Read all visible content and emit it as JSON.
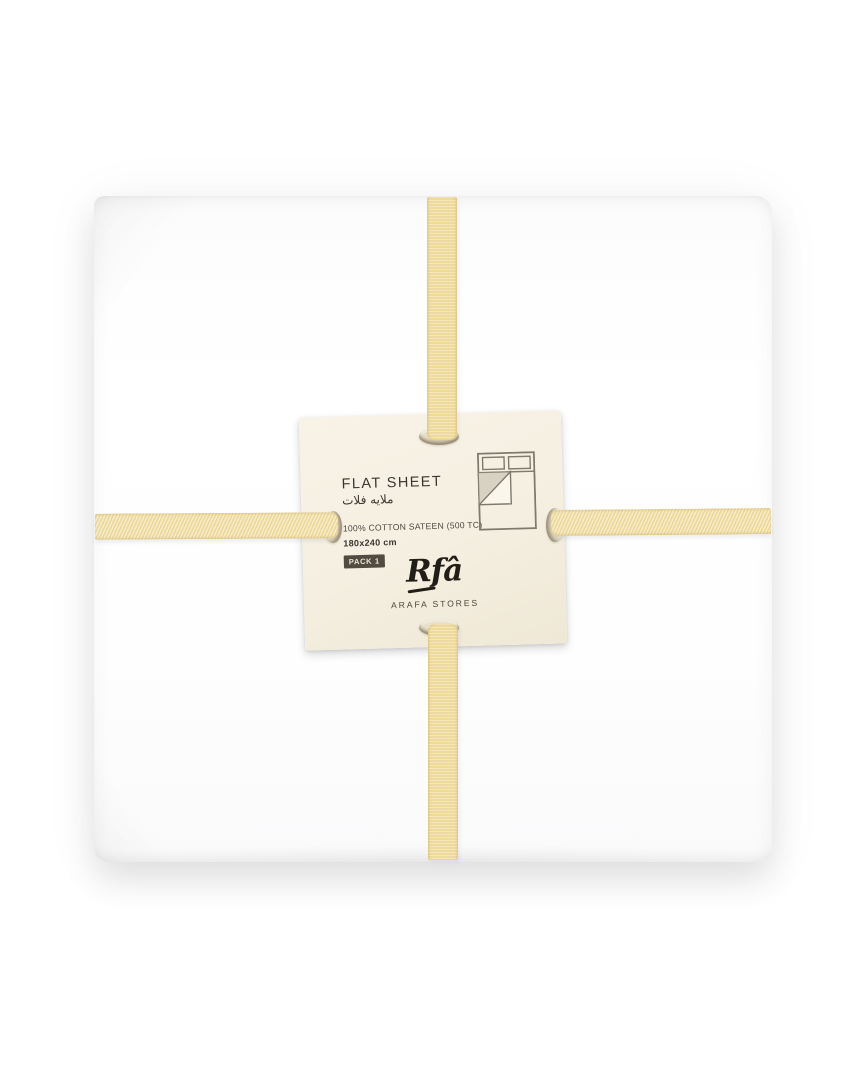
{
  "product": {
    "label": {
      "title": "FLAT SHEET",
      "title_arabic": "ملايه فلات",
      "material": "100% COTTON SATEEN (500 TC)",
      "size": "180x240 cm",
      "pack": "PACK 1",
      "brand": "Rfâ",
      "store": "ARAFA STORES"
    },
    "packaging": {
      "sheet_color": "#fefefe",
      "ribbon_color": "#f2dfa2",
      "card_color": "#f5efe1",
      "badge_color": "#504c41",
      "text_color": "#3a3731"
    },
    "icons": {
      "bed_icon": "bed-with-folded-sheet-corner"
    }
  }
}
